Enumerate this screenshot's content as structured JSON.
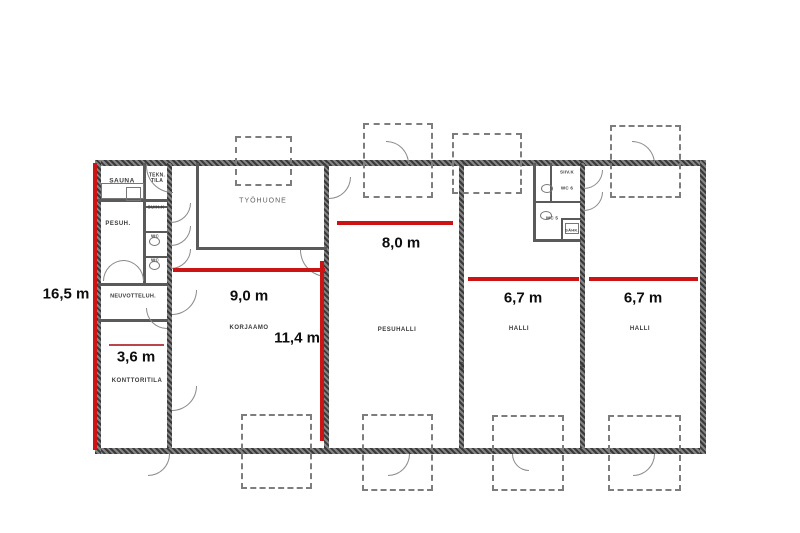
{
  "meta": {
    "type": "floor-plan",
    "unit": "m"
  },
  "colors": {
    "background": "#ffffff",
    "wall": "#4a4a4a",
    "thin_wall": "#5a5a5a",
    "plan_line": "#8a8a8a",
    "dashed_opening": "#7d7d7d",
    "measure_red": "#cc1414",
    "measure_red_thin": "#b84848",
    "label_black": "#0d0d0d",
    "room_label_gray": "#3a3a3a"
  },
  "measurements": [
    {
      "label": "16,5 m",
      "dir": "v",
      "x": 93,
      "y": 163,
      "len": 287,
      "th": 4,
      "tx": 66,
      "ty": 294,
      "thin": false
    },
    {
      "label": "9,0 m",
      "dir": "h",
      "x": 173,
      "y": 268,
      "len": 152,
      "th": 4,
      "tx": 249,
      "ty": 296,
      "thin": false
    },
    {
      "label": "8,0 m",
      "dir": "h",
      "x": 337,
      "y": 221,
      "len": 116,
      "th": 4,
      "tx": 401,
      "ty": 243,
      "thin": false
    },
    {
      "label": "11,4 m",
      "dir": "v",
      "x": 320,
      "y": 261,
      "len": 180,
      "th": 4,
      "tx": 297,
      "ty": 338,
      "thin": false
    },
    {
      "label": "3,6 m",
      "dir": "h",
      "x": 109,
      "y": 344,
      "len": 55,
      "th": 2,
      "tx": 136,
      "ty": 357,
      "thin": true
    },
    {
      "label": "6,7 m",
      "dir": "h",
      "x": 468,
      "y": 277,
      "len": 111,
      "th": 4,
      "tx": 523,
      "ty": 298,
      "thin": false
    },
    {
      "label": "6,7 m",
      "dir": "h",
      "x": 589,
      "y": 277,
      "len": 109,
      "th": 4,
      "tx": 643,
      "ty": 298,
      "thin": false
    }
  ],
  "rooms": [
    {
      "label": "SAUNA",
      "x": 122,
      "y": 181,
      "fs": 6.5,
      "light": false
    },
    {
      "label": "TEKN.\nTILA",
      "x": 157,
      "y": 178,
      "fs": 5,
      "light": false
    },
    {
      "label": "PESUH.",
      "x": 118,
      "y": 224,
      "fs": 6,
      "light": false
    },
    {
      "label": "SUIH.K",
      "x": 156,
      "y": 207,
      "fs": 4.5,
      "light": false
    },
    {
      "label": "WC",
      "x": 155,
      "y": 236,
      "fs": 4.5,
      "light": false
    },
    {
      "label": "WC",
      "x": 155,
      "y": 260,
      "fs": 4.5,
      "light": false
    },
    {
      "label": "NEUVOTTELUH.",
      "x": 133,
      "y": 296,
      "fs": 5.5,
      "light": false
    },
    {
      "label": "KONTTORITILA",
      "x": 137,
      "y": 381,
      "fs": 6,
      "light": false
    },
    {
      "label": "KORJAAMO",
      "x": 249,
      "y": 328,
      "fs": 6,
      "light": false
    },
    {
      "label": "TYÖHUONE",
      "x": 263,
      "y": 201,
      "fs": 7,
      "light": true
    },
    {
      "label": "PESUHALLI",
      "x": 397,
      "y": 330,
      "fs": 6,
      "light": false
    },
    {
      "label": "HALLI",
      "x": 519,
      "y": 329,
      "fs": 6,
      "light": false
    },
    {
      "label": "HALLI",
      "x": 640,
      "y": 329,
      "fs": 6,
      "light": false
    },
    {
      "label": "SIIV.K",
      "x": 567,
      "y": 172,
      "fs": 4.5,
      "light": false
    },
    {
      "label": "WC 6",
      "x": 567,
      "y": 188,
      "fs": 4.5,
      "light": false
    },
    {
      "label": "WC 5",
      "x": 552,
      "y": 218,
      "fs": 4.5,
      "light": false
    },
    {
      "label": "SÄHK.",
      "x": 572,
      "y": 230,
      "fs": 4,
      "light": false
    }
  ],
  "wall_tags": [
    {
      "label": "E30",
      "x": 462,
      "y": 366
    },
    {
      "label": "E30",
      "x": 582,
      "y": 366
    }
  ],
  "geometry": {
    "walls_ext": [
      [
        98,
        160,
        608,
        6
      ],
      [
        98,
        448,
        608,
        6
      ],
      [
        95,
        160,
        6,
        294
      ],
      [
        700,
        160,
        6,
        294
      ]
    ],
    "walls_int": [
      [
        167,
        163,
        5,
        285
      ],
      [
        324,
        163,
        5,
        285
      ],
      [
        459,
        163,
        5,
        285
      ],
      [
        580,
        163,
        5,
        285
      ]
    ],
    "walls_thin": [
      [
        98,
        199,
        70,
        3
      ],
      [
        143,
        163,
        3,
        120
      ],
      [
        145,
        206,
        23,
        2
      ],
      [
        145,
        231,
        23,
        2
      ],
      [
        145,
        256,
        23,
        2
      ],
      [
        98,
        283,
        70,
        3
      ],
      [
        98,
        319,
        70,
        3
      ],
      [
        196,
        163,
        3,
        87
      ],
      [
        196,
        247,
        131,
        3
      ],
      [
        533,
        163,
        3,
        79
      ],
      [
        533,
        239,
        48,
        3
      ],
      [
        550,
        163,
        2,
        40
      ],
      [
        533,
        201,
        48,
        2
      ],
      [
        561,
        218,
        2,
        23
      ],
      [
        561,
        218,
        20,
        2
      ]
    ],
    "dashed_rects": [
      [
        235,
        136,
        53,
        46
      ],
      [
        363,
        123,
        66,
        71
      ],
      [
        452,
        133,
        66,
        57
      ],
      [
        610,
        125,
        67,
        69
      ],
      [
        241,
        414,
        67,
        71
      ],
      [
        362,
        414,
        67,
        73
      ],
      [
        492,
        415,
        68,
        72
      ],
      [
        608,
        415,
        69,
        72
      ]
    ],
    "doors": [
      [
        146,
        166,
        26,
        "bl"
      ],
      [
        386,
        141,
        22,
        "tr"
      ],
      [
        632,
        141,
        22,
        "tr"
      ],
      [
        388,
        454,
        21,
        "br"
      ],
      [
        633,
        454,
        21,
        "br"
      ],
      [
        148,
        454,
        21,
        "br"
      ],
      [
        512,
        454,
        16,
        "bl"
      ],
      [
        300,
        250,
        26,
        "bl"
      ],
      [
        329,
        177,
        21,
        "br"
      ],
      [
        103,
        260,
        20,
        "tl"
      ],
      [
        123,
        260,
        20,
        "tr"
      ],
      [
        172,
        290,
        24,
        "br"
      ],
      [
        146,
        308,
        20,
        "bl"
      ],
      [
        172,
        386,
        24,
        "br"
      ],
      [
        584,
        170,
        18,
        "br"
      ],
      [
        584,
        192,
        18,
        "br"
      ],
      [
        171,
        203,
        19,
        "br"
      ],
      [
        171,
        226,
        19,
        "br"
      ],
      [
        171,
        249,
        19,
        "br"
      ]
    ],
    "fixtures": [
      {
        "type": "rect",
        "x": 101,
        "y": 183,
        "w": 41,
        "h": 14
      },
      {
        "type": "rect",
        "x": 126,
        "y": 187,
        "w": 13,
        "h": 12
      },
      {
        "type": "oval",
        "x": 149,
        "y": 237,
        "w": 9,
        "h": 7
      },
      {
        "type": "oval",
        "x": 149,
        "y": 261,
        "w": 9,
        "h": 7
      },
      {
        "type": "oval",
        "x": 541,
        "y": 184,
        "w": 10,
        "h": 7
      },
      {
        "type": "oval",
        "x": 540,
        "y": 211,
        "w": 10,
        "h": 7
      },
      {
        "type": "rect",
        "x": 565,
        "y": 223,
        "w": 12,
        "h": 9
      }
    ]
  }
}
